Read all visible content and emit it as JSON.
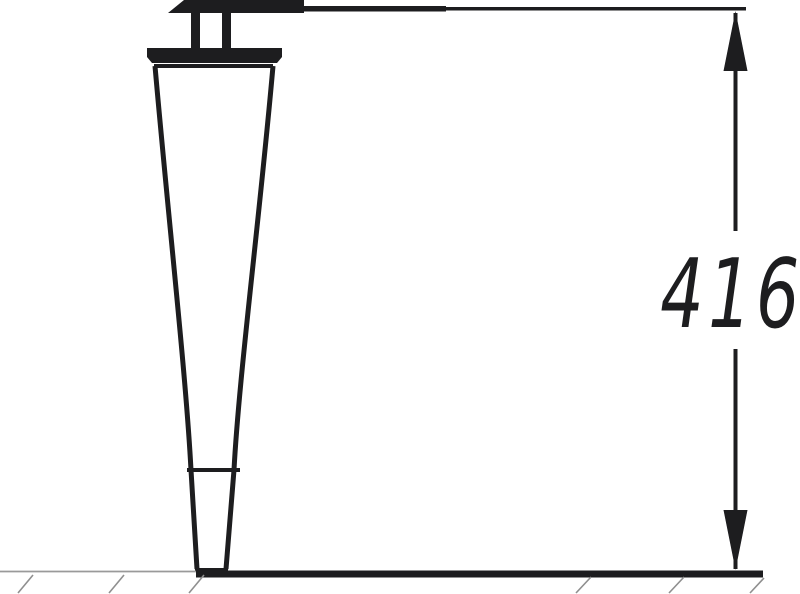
{
  "dimension": {
    "value": "416"
  },
  "colors": {
    "ink": "#1d1d1f",
    "ground_line": "#9a9a9a",
    "hatch": "#8f8f8f",
    "background": "#ffffff"
  }
}
